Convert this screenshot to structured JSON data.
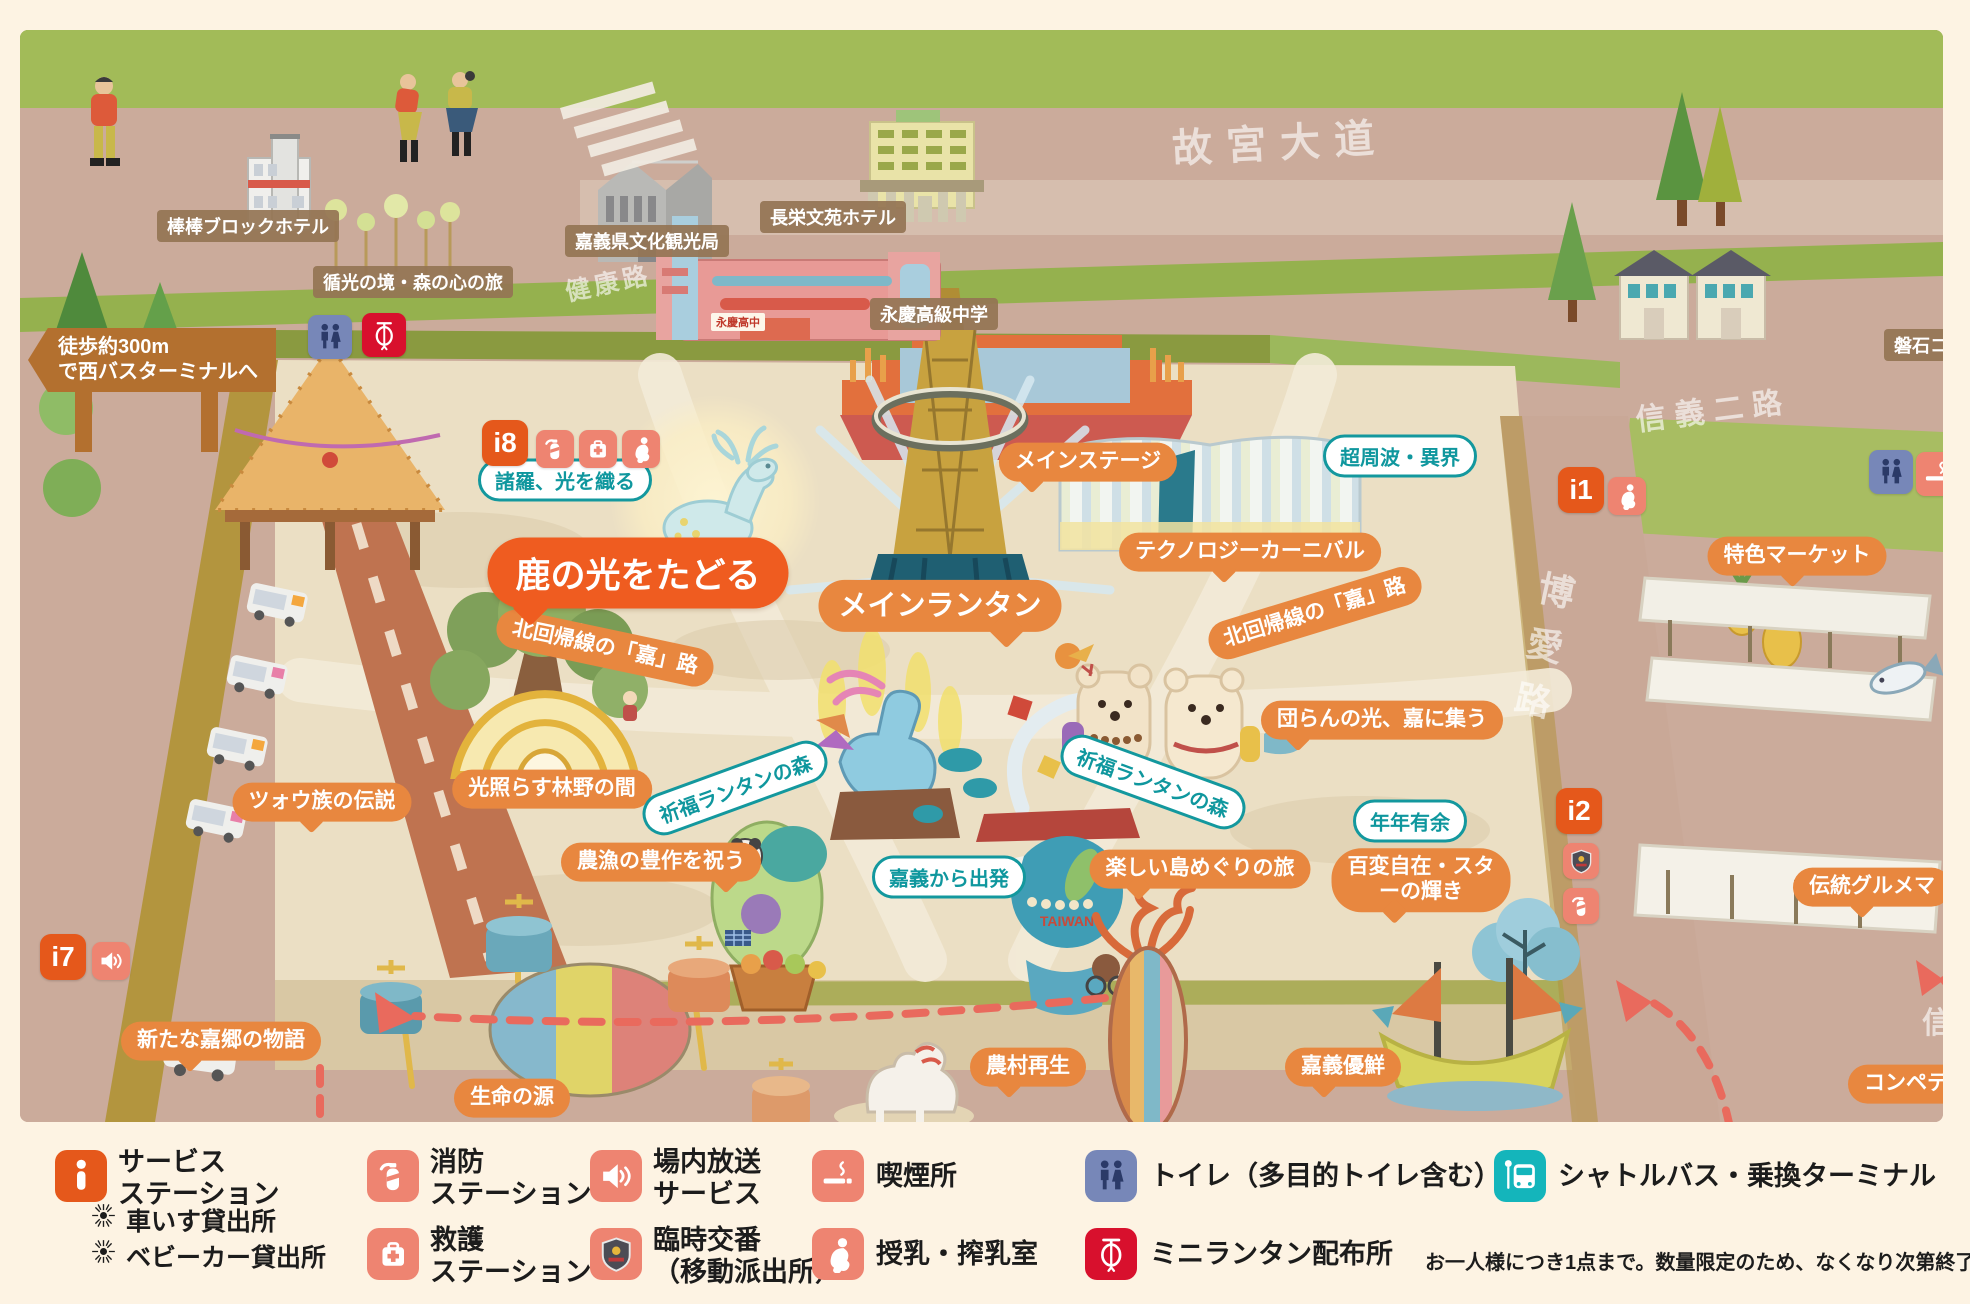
{
  "map": {
    "streets": {
      "gugong_avenue": "故宮大道",
      "jiankang_road": "健康路",
      "xinyi_2nd_road": "信義二路",
      "boai_road": "博愛路",
      "partial_right_street": "信"
    },
    "sign_bus_terminal": {
      "line1": "徒歩約300m",
      "line2": "で西バスターミナルへ"
    },
    "place_labels": {
      "bangbang_hotel": "棒棒ブロックホテル",
      "light_forest_journey": "循光の境・森の心の旅",
      "culture_tourism_bureau": "嘉義県文化観光局",
      "choei_bunen_hotel": "長栄文苑ホテル",
      "yongqing_high_school": "永慶高級中学",
      "banseki_partial": "磐石コ",
      "school_rooftop_sign": "永慶高中"
    },
    "highlight_label": "鹿の光をたどる",
    "orange_labels": {
      "main_stage": "メインステージ",
      "main_lantern": "メインランタン",
      "technology_carnival": "テクノロジーカーニバル",
      "tropic_of_cancer_road_west": "北回帰線の「嘉」路",
      "tropic_of_cancer_road_east": "北回帰線の「嘉」路",
      "reunion_light": "団らんの光、嘉に集う",
      "specialty_market": "特色マーケット",
      "tsou_legend": "ツォウ族の伝説",
      "light_forest_hall": "光照らす林野の間",
      "harvest_celebration": "農漁の豊作を祝う",
      "island_tour": "楽しい島めぐりの旅",
      "star_brilliance_line1": "百変自在・スタ",
      "star_brilliance_line2": "ーの輝き",
      "new_kakyo_story": "新たな嘉郷の物語",
      "source_of_life": "生命の源",
      "rural_rebirth": "農村再生",
      "chiayi_yuxian": "嘉義優鮮",
      "traditional_gourmet_partial": "伝統グルメマ",
      "competition_partial": "コンペテ"
    },
    "teal_labels": {
      "zhuluo_weaving_light": "諸羅、光を織る",
      "ultra_frequency": "超周波・異界",
      "blessing_lantern_forest_west": "祈福ランタンの森",
      "blessing_lantern_forest_east": "祈福ランタンの森",
      "departure_from_chiayi": "嘉義から出発",
      "yearly_abundance": "年年有余"
    },
    "info_badges": {
      "i8": "i8",
      "i1": "i1",
      "i2": "i2",
      "i7": "i7"
    },
    "artwork_text": {
      "taiwan_globe": "TAIWAN"
    }
  },
  "legend": {
    "service": {
      "title_line1": "サービス",
      "title_line2": "ステーション",
      "sub1": "車いす貸出所",
      "sub2": "ベビーカー貸出所"
    },
    "fire": {
      "line1": "消防",
      "line2": "ステーション"
    },
    "rescue": {
      "line1": "救護",
      "line2": "ステーション"
    },
    "broadcast": {
      "line1": "場内放送",
      "line2": "サービス"
    },
    "police": {
      "line1": "臨時交番",
      "line2": "（移動派出所）"
    },
    "smoking": {
      "label": "喫煙所"
    },
    "nursing": {
      "label": "授乳・搾乳室"
    },
    "toilet": {
      "label": "トイレ（多目的トイレ含む）"
    },
    "lantern": {
      "label": "ミニランタン配布所",
      "note": "お一人様につき1点まで。数量限定のため、なくなり次第終了となります。"
    },
    "bus": {
      "label": "シャトルバス・乗換ターミナル"
    }
  },
  "colors": {
    "accent_orange": "#e8873f",
    "highlight_orange": "#ef5c20",
    "teal": "#13989e",
    "badge_orange": "#e5581b",
    "icon_salmon": "#ee8471",
    "toilet_blue": "#7787b8",
    "lantern_red": "#d8102d",
    "bus_teal": "#14b5bb",
    "arrow_red": "#e96a5d"
  }
}
